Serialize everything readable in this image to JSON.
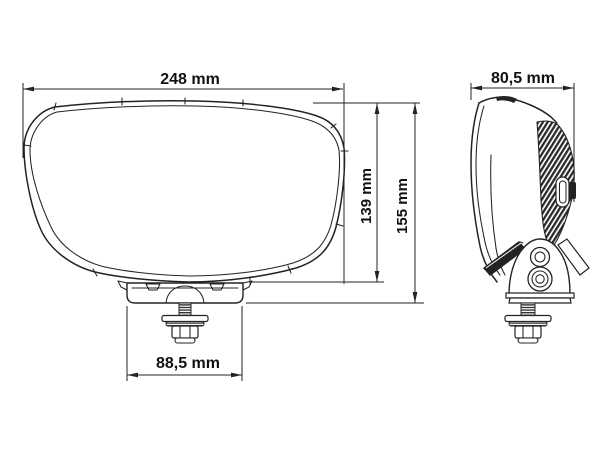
{
  "drawing": {
    "unit": "mm",
    "labels": {
      "width": "248 mm",
      "body_height": "139 mm",
      "total_height": "155 mm",
      "bracket_width": "88,5 mm",
      "depth": "80,5 mm"
    },
    "values": {
      "width_mm": 248,
      "body_height_mm": 139,
      "total_height_mm": 155,
      "bracket_width_mm": 88.5,
      "depth_mm": 80.5
    },
    "colors": {
      "line": "#232323",
      "text": "#111111",
      "background": "#ffffff"
    }
  }
}
